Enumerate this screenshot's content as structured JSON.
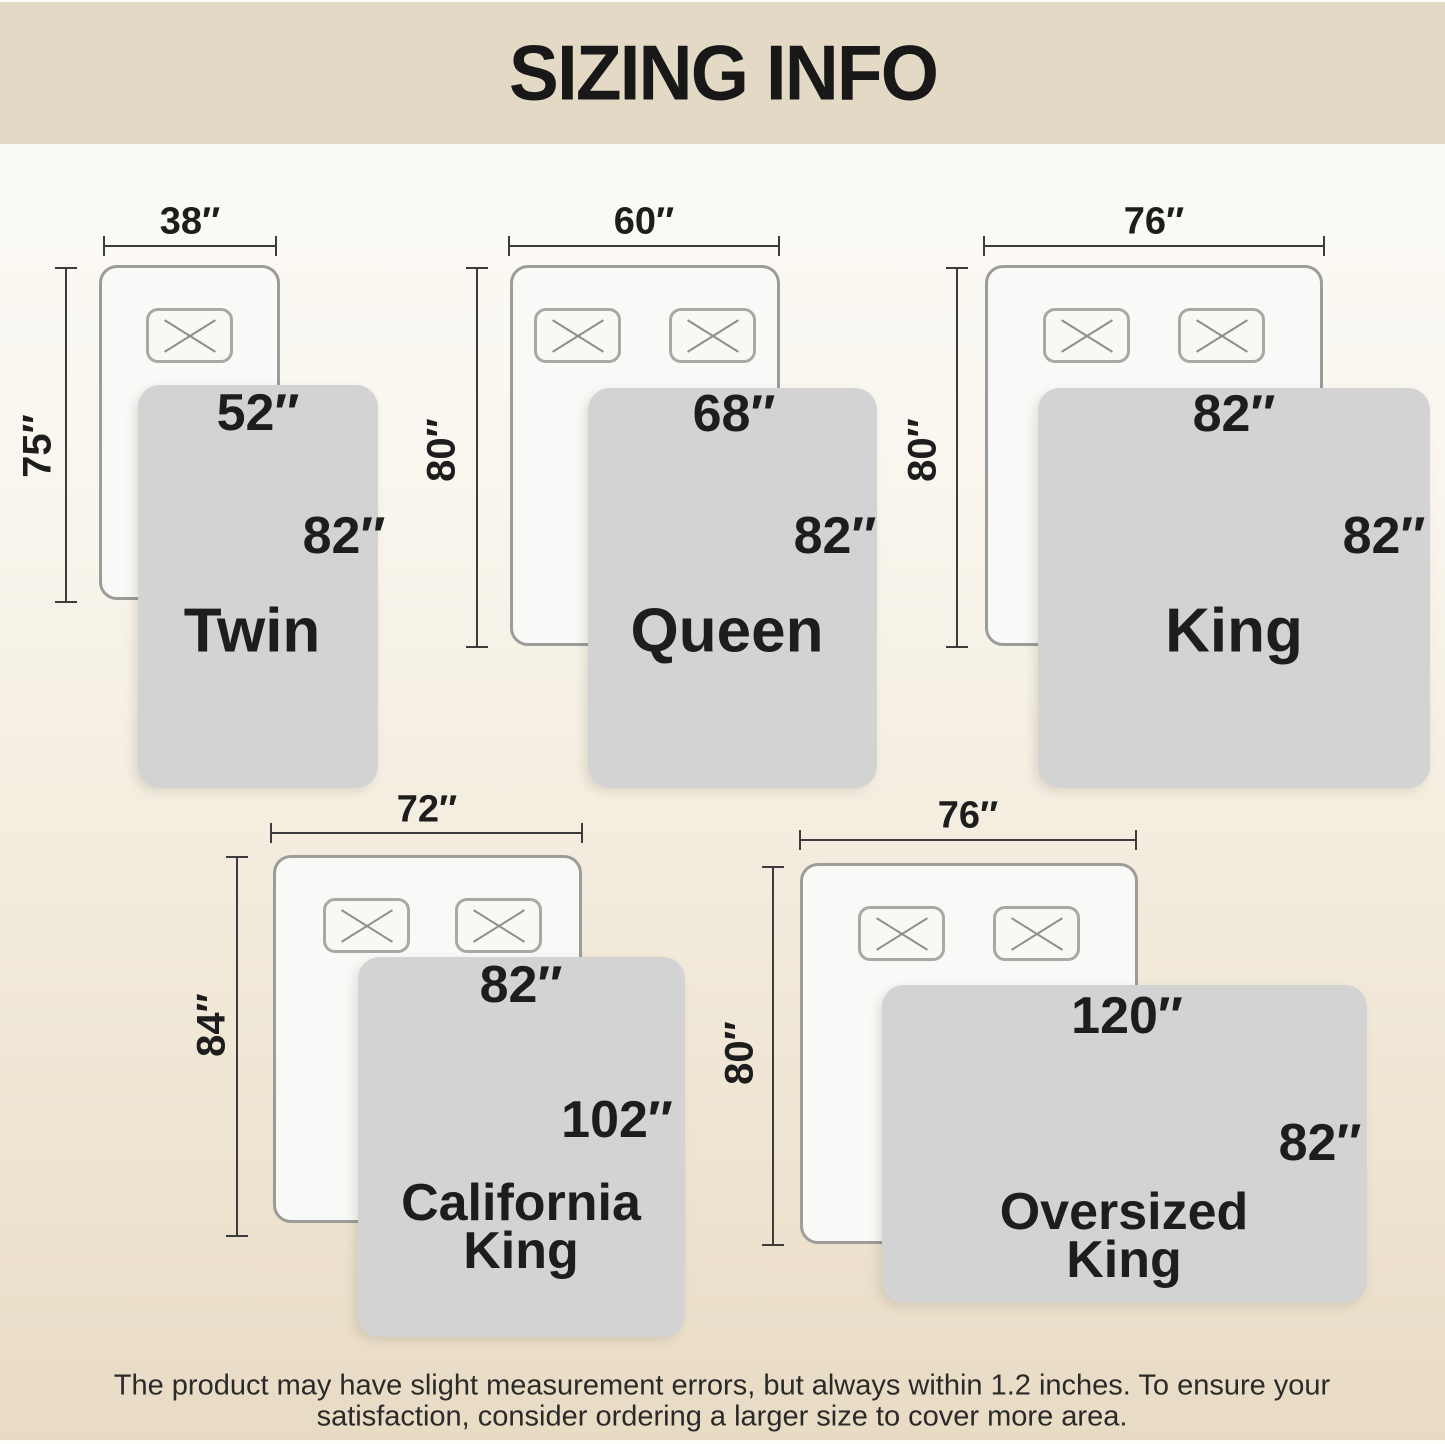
{
  "title": "SIZING INFO",
  "footer": {
    "line1": "The product may have slight measurement errors, but always within 1.2 inches. To ensure your",
    "line2": "satisfaction, consider ordering a larger size to cover more area."
  },
  "colors": {
    "header_band": "#e4d9c5",
    "background_bottom": "#e8dbc4",
    "blanket": "#d3d3d4",
    "bed_fill": "#f9f9f7",
    "bed_border": "#9c9c99",
    "text": "#1d1d1d"
  },
  "sizes": [
    {
      "name_line1": "Twin",
      "name_line2": "",
      "bed_width": "38″",
      "bed_length": "75″",
      "blanket_width": "52″",
      "blanket_length": "82″",
      "pillows": 1
    },
    {
      "name_line1": "Queen",
      "name_line2": "",
      "bed_width": "60″",
      "bed_length": "80″",
      "blanket_width": "68″",
      "blanket_length": "82″",
      "pillows": 2
    },
    {
      "name_line1": "King",
      "name_line2": "",
      "bed_width": "76″",
      "bed_length": "80″",
      "blanket_width": "82″",
      "blanket_length": "82″",
      "pillows": 2
    },
    {
      "name_line1": "California",
      "name_line2": "King",
      "bed_width": "72″",
      "bed_length": "84″",
      "blanket_width": "82″",
      "blanket_length": "102″",
      "pillows": 2
    },
    {
      "name_line1": "Oversized",
      "name_line2": "King",
      "bed_width": "76″",
      "bed_length": "80″",
      "blanket_width": "120″",
      "blanket_length": "82″",
      "pillows": 2
    }
  ]
}
